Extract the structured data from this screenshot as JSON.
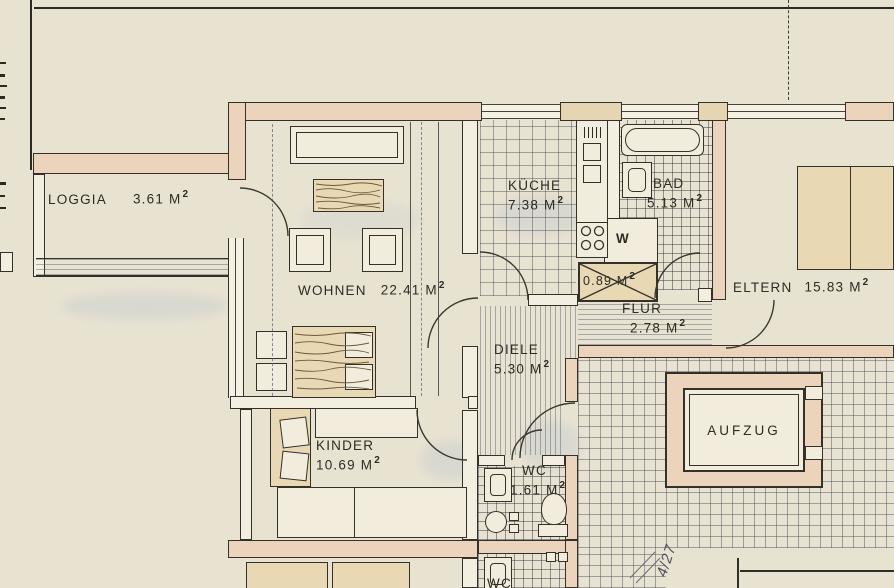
{
  "sheet": {
    "page_ref": "4/27"
  },
  "rooms": {
    "loggia": {
      "name": "LOGGIA",
      "area": "3.61 M",
      "sup": "2"
    },
    "wohnen": {
      "name": "WOHNEN",
      "area": "22.41 M",
      "sup": "2"
    },
    "kueche": {
      "name": "KÜCHE",
      "area": "7.38 M",
      "sup": "2"
    },
    "bad": {
      "name": "BAD",
      "area": "5.13 M",
      "sup": "2"
    },
    "eltern": {
      "name": "ELTERN",
      "area": "15.83 M",
      "sup": "2"
    },
    "schrank": {
      "area": "0.89 M",
      "sup": "2"
    },
    "w_shaft": {
      "name": "W"
    },
    "flur": {
      "name": "FLUR",
      "area": "2.78 M",
      "sup": "2"
    },
    "diele": {
      "name": "DIELE",
      "area": "5.30 M",
      "sup": "2"
    },
    "kinder": {
      "name": "KINDER",
      "area": "10.69 M",
      "sup": "2"
    },
    "wc": {
      "name": "WC",
      "area": "1.61 M",
      "sup": "2"
    },
    "aufzug": {
      "name": "AUFZUG"
    },
    "wc_lower": {
      "name": "WC"
    }
  },
  "colors": {
    "paper": "#e8e3d1",
    "wall_pink": "#ecd3bc",
    "wall_tan": "#e5d5b2",
    "line": "#33312a",
    "smudge_blue": "#8fa3cc"
  }
}
